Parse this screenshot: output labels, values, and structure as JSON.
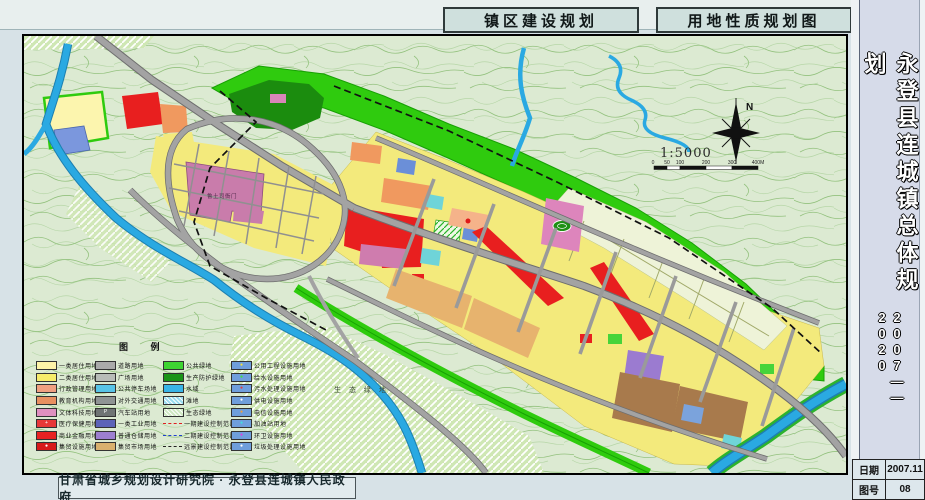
{
  "header": {
    "title_left": "镇区建设规划",
    "title_right": "用地性质规划图"
  },
  "sidebar": {
    "title_vertical": "永登县连城镇总体规划",
    "years": "2007——2020"
  },
  "footer": {
    "credit": "甘肃省城乡规划设计研究院 · 永登县连城镇人民政府",
    "date_label": "日期",
    "date_value": "2007.11",
    "sheet_label": "图号",
    "sheet_value": "08"
  },
  "map": {
    "labels": {
      "north": "N",
      "scale": "1:5000",
      "eco_green": "生 态 绿 地",
      "heritage": "鲁土司衙门"
    },
    "scalebar_ticks": [
      "0",
      "50",
      "100",
      "200",
      "300",
      "400M"
    ],
    "legend": {
      "title": "图 例",
      "columns": [
        [
          {
            "label": "一类居住用地",
            "color": "#fdf3a8"
          },
          {
            "label": "二类居住用地",
            "color": "#f6ec6a"
          },
          {
            "label": "行政管理用地",
            "color": "#f0a080"
          },
          {
            "label": "教育机构用地",
            "color": "#e89060"
          },
          {
            "label": "文体科技用地",
            "color": "#e090c0"
          },
          {
            "label": "医疗保健用地",
            "color": "#e83838",
            "icon": "+",
            "icon_color": "#ffffff"
          },
          {
            "label": "商业金融用地",
            "color": "#e82222"
          },
          {
            "label": "集贸设施用地",
            "color": "#d81a1a",
            "icon": "●",
            "icon_color": "#ffffff"
          }
        ],
        [
          {
            "label": "道路用地",
            "color": "#aaaaaa"
          },
          {
            "label": "广场用地",
            "color": "#b8bcb8"
          },
          {
            "label": "公共停车场地",
            "color": "#58c4e8"
          },
          {
            "label": "对外交通用地",
            "color": "#8f9494"
          },
          {
            "label": "汽车站用地",
            "color": "#6f7474",
            "icon": "P",
            "icon_color": "#ffffff"
          },
          {
            "label": "一类工业用地",
            "color": "#5c63b8"
          },
          {
            "label": "普通仓储用地",
            "color": "#9d7fd0"
          },
          {
            "label": "集贸市场用地",
            "color": "#d9b06e"
          }
        ],
        [
          {
            "label": "公共绿地",
            "color": "#3ed432"
          },
          {
            "label": "生产防护绿地",
            "color": "#1a9418"
          },
          {
            "label": "水域",
            "color": "#38b4e8"
          },
          {
            "label": "滩地",
            "color": "#9adcf0",
            "hatch": true
          },
          {
            "label": "生态绿地",
            "color": "#cfe8c2",
            "hatch": true
          },
          {
            "label": "一期建设控制范围",
            "type": "line",
            "color": "#e02020"
          },
          {
            "label": "二期建设控制范围",
            "type": "line",
            "color": "#2040d0"
          },
          {
            "label": "远景建设控制范围",
            "type": "line",
            "color": "#222222"
          }
        ],
        [
          {
            "label": "公用工程设施用地",
            "color": "#6f9edc",
            "icon": "●",
            "icon_color": "#f0e040"
          },
          {
            "label": "给水设施用地",
            "color": "#6f9edc",
            "icon": "●",
            "icon_color": "#40e040"
          },
          {
            "label": "污水处理设施用地",
            "color": "#6f9edc",
            "icon": "●",
            "icon_color": "#e04040"
          },
          {
            "label": "供电设施用地",
            "color": "#6f9edc",
            "icon": "●",
            "icon_color": "#ffffff"
          },
          {
            "label": "电信设施用地",
            "color": "#6f9edc",
            "icon": "●",
            "icon_color": "#f0a040"
          },
          {
            "label": "加油站用地",
            "color": "#6f9edc",
            "icon": "●",
            "icon_color": "#40e0e0"
          },
          {
            "label": "环卫设施用地",
            "color": "#6f9edc",
            "icon": "●",
            "icon_color": "#e040e0"
          },
          {
            "label": "垃圾处理设施用地",
            "color": "#6f9edc",
            "icon": "●",
            "icon_color": "#ffffff"
          }
        ]
      ]
    }
  }
}
